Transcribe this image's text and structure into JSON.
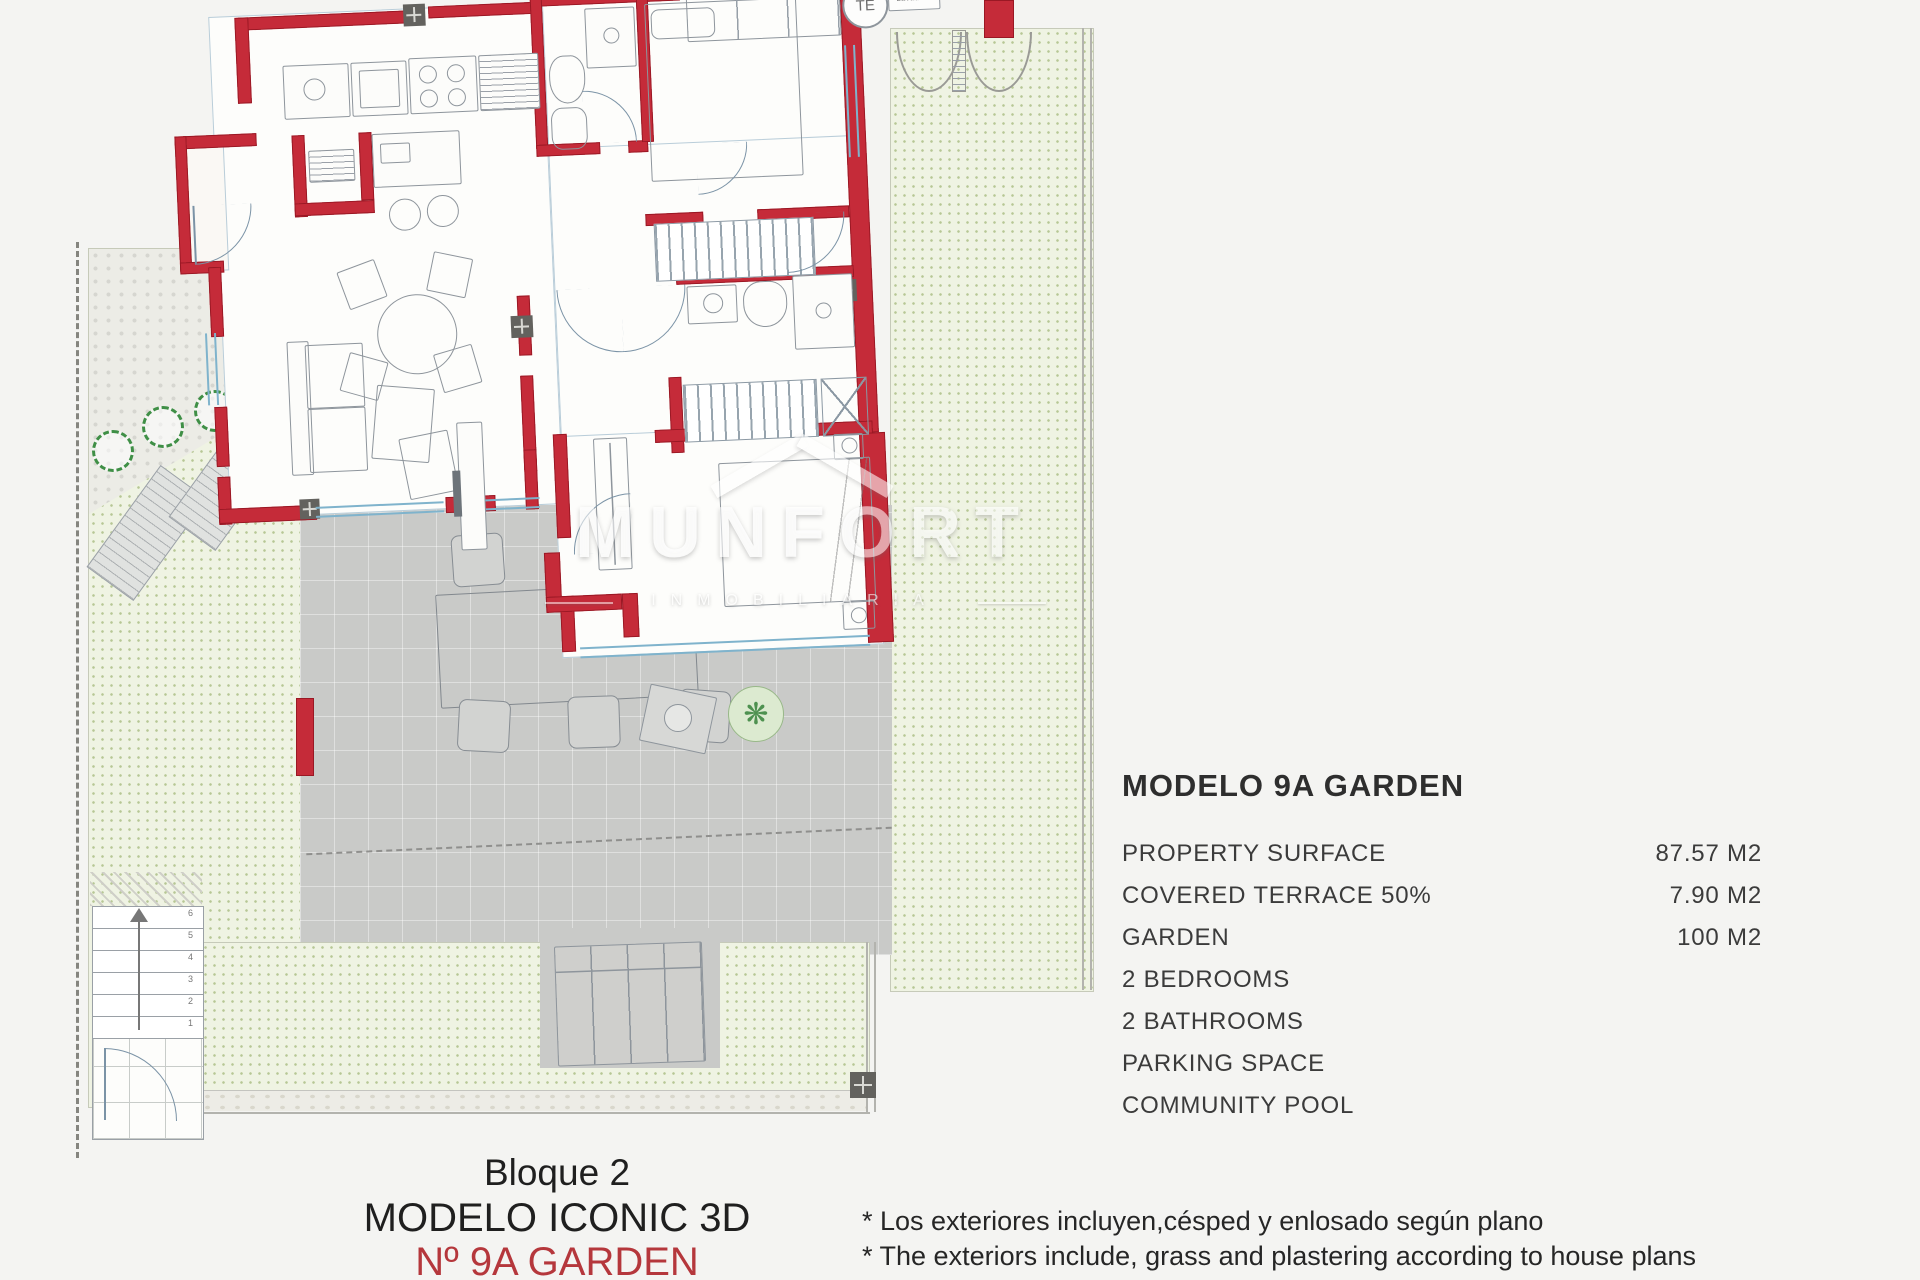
{
  "page": {
    "background": "#f4f4f2"
  },
  "panel": {
    "title": "MODELO 9A GARDEN",
    "rows": [
      {
        "label": "PROPERTY SURFACE",
        "value": "87.57 M2"
      },
      {
        "label": "COVERED TERRACE 50%",
        "value": "7.90 M2"
      },
      {
        "label": "GARDEN",
        "value": "100 M2"
      },
      {
        "label": "2 BEDROOMS",
        "value": ""
      },
      {
        "label": "2 BATHROOMS",
        "value": ""
      },
      {
        "label": "PARKING SPACE",
        "value": ""
      },
      {
        "label": "COMMUNITY POOL",
        "value": ""
      }
    ]
  },
  "footer": {
    "lines": [
      "Bloque 2",
      "MODELO ICONIC 3D",
      "Nº 9A GARDEN"
    ],
    "accent_color": "#b5373c",
    "notes": [
      "* Los exteriores incluyen,césped y enlosado según plano",
      "* The exteriors include, grass and plastering according to house plans"
    ]
  },
  "plan": {
    "labels": {
      "water_heater": "TE",
      "washing_machine": "Lavadora"
    },
    "stairs": {
      "numbers": [
        "6",
        "5",
        "4",
        "3",
        "2",
        "1"
      ]
    },
    "watermark": {
      "name": "MUNFORT",
      "subtitle": "INMOBILIARIA"
    },
    "icons": {
      "plant_icon": "❋"
    },
    "colors": {
      "wall_red": "#c52b39",
      "glazing_blue": "#7fb3cc",
      "garden_green": "#eff3e3",
      "terrace_gray": "#c9cac8",
      "accent_red_text": "#b5373c"
    }
  }
}
